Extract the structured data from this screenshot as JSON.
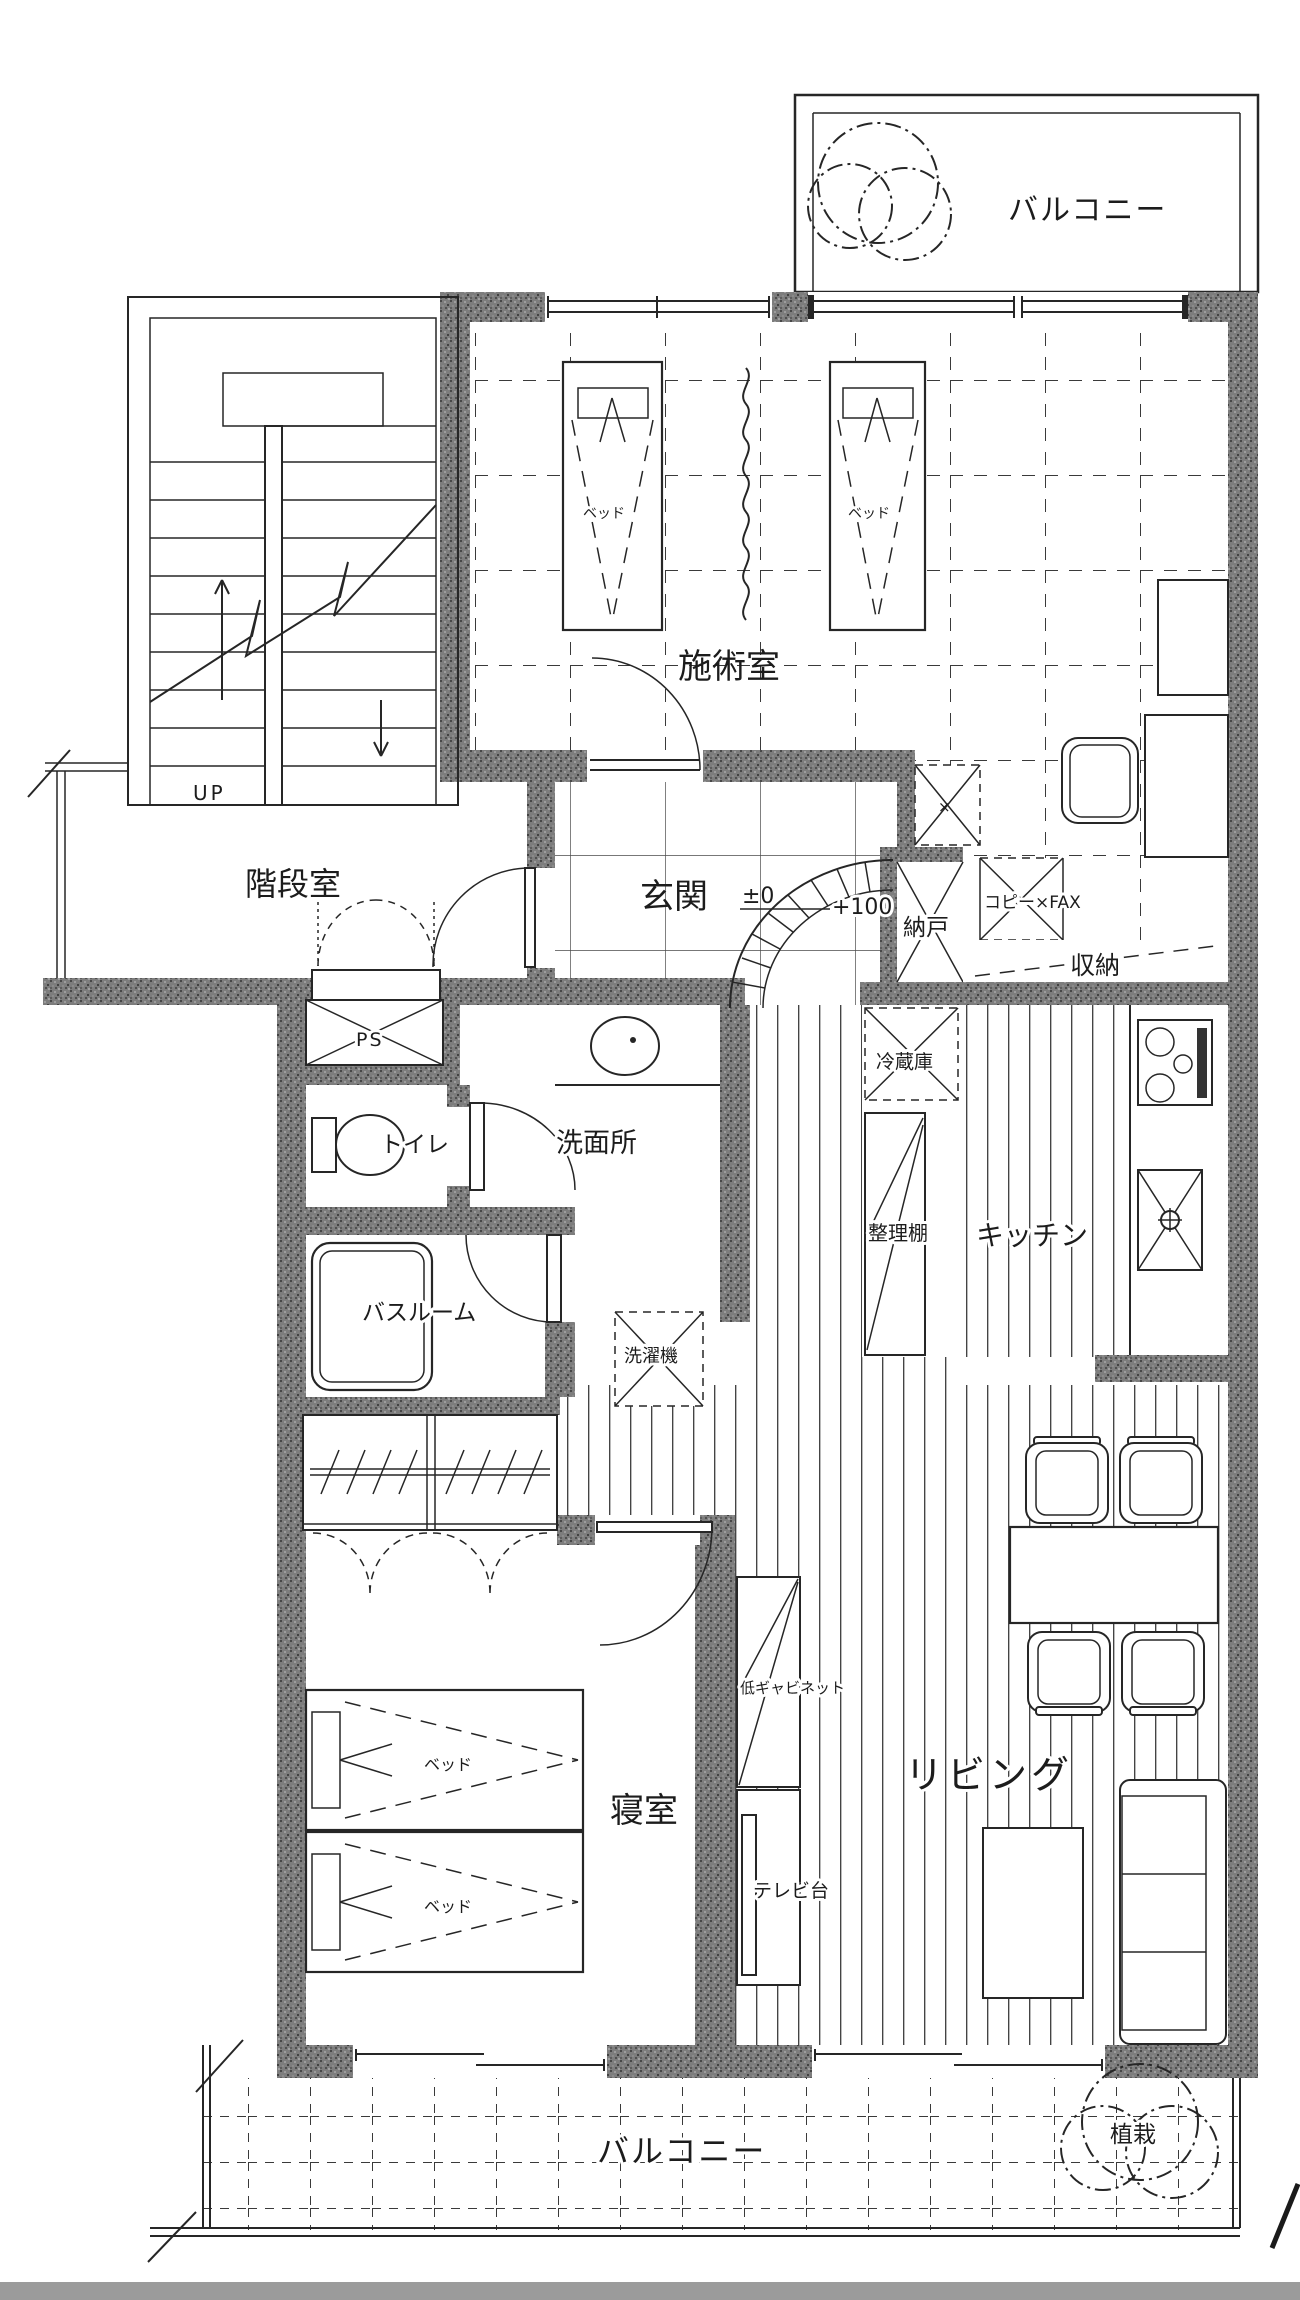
{
  "document": {
    "type": "floor-plan-scan"
  },
  "colors": {
    "line": "#262626",
    "wall_fill": "#7d7d7d",
    "paper": "#ffffff",
    "scan_edge": "#9b9b9b"
  },
  "rooms": {
    "balcony_top": {
      "label": "バルコニー"
    },
    "treatment": {
      "label": "施術室",
      "beds": [
        "ベッド",
        "ベッド"
      ]
    },
    "stairwell": {
      "label": "階段室",
      "up": "UP"
    },
    "entrance": {
      "label": "玄関",
      "level_zero": "±0",
      "level_plus": "+100"
    },
    "storage_nando": {
      "label": "納戸"
    },
    "office": {
      "copy_fax": "コピー×FAX",
      "storage": "収納",
      "shaft_mark": "×"
    },
    "ps": {
      "label": "PS"
    },
    "toilet": {
      "label": "トイレ"
    },
    "washroom": {
      "label": "洗面所"
    },
    "bathroom": {
      "label": "バスルーム"
    },
    "laundry": {
      "label": "洗濯機"
    },
    "kitchen": {
      "label": "キッチン",
      "fridge": "冷蔵庫",
      "shelf": "整理棚"
    },
    "living": {
      "label": "リビング",
      "low_cabinet": "低ギャビネット",
      "tv_stand": "テレビ台"
    },
    "bedroom": {
      "label": "寝室",
      "beds": [
        "ベッド",
        "ベッド"
      ]
    },
    "balcony_bottom": {
      "label": "バルコニー",
      "planting": "植栽"
    }
  }
}
